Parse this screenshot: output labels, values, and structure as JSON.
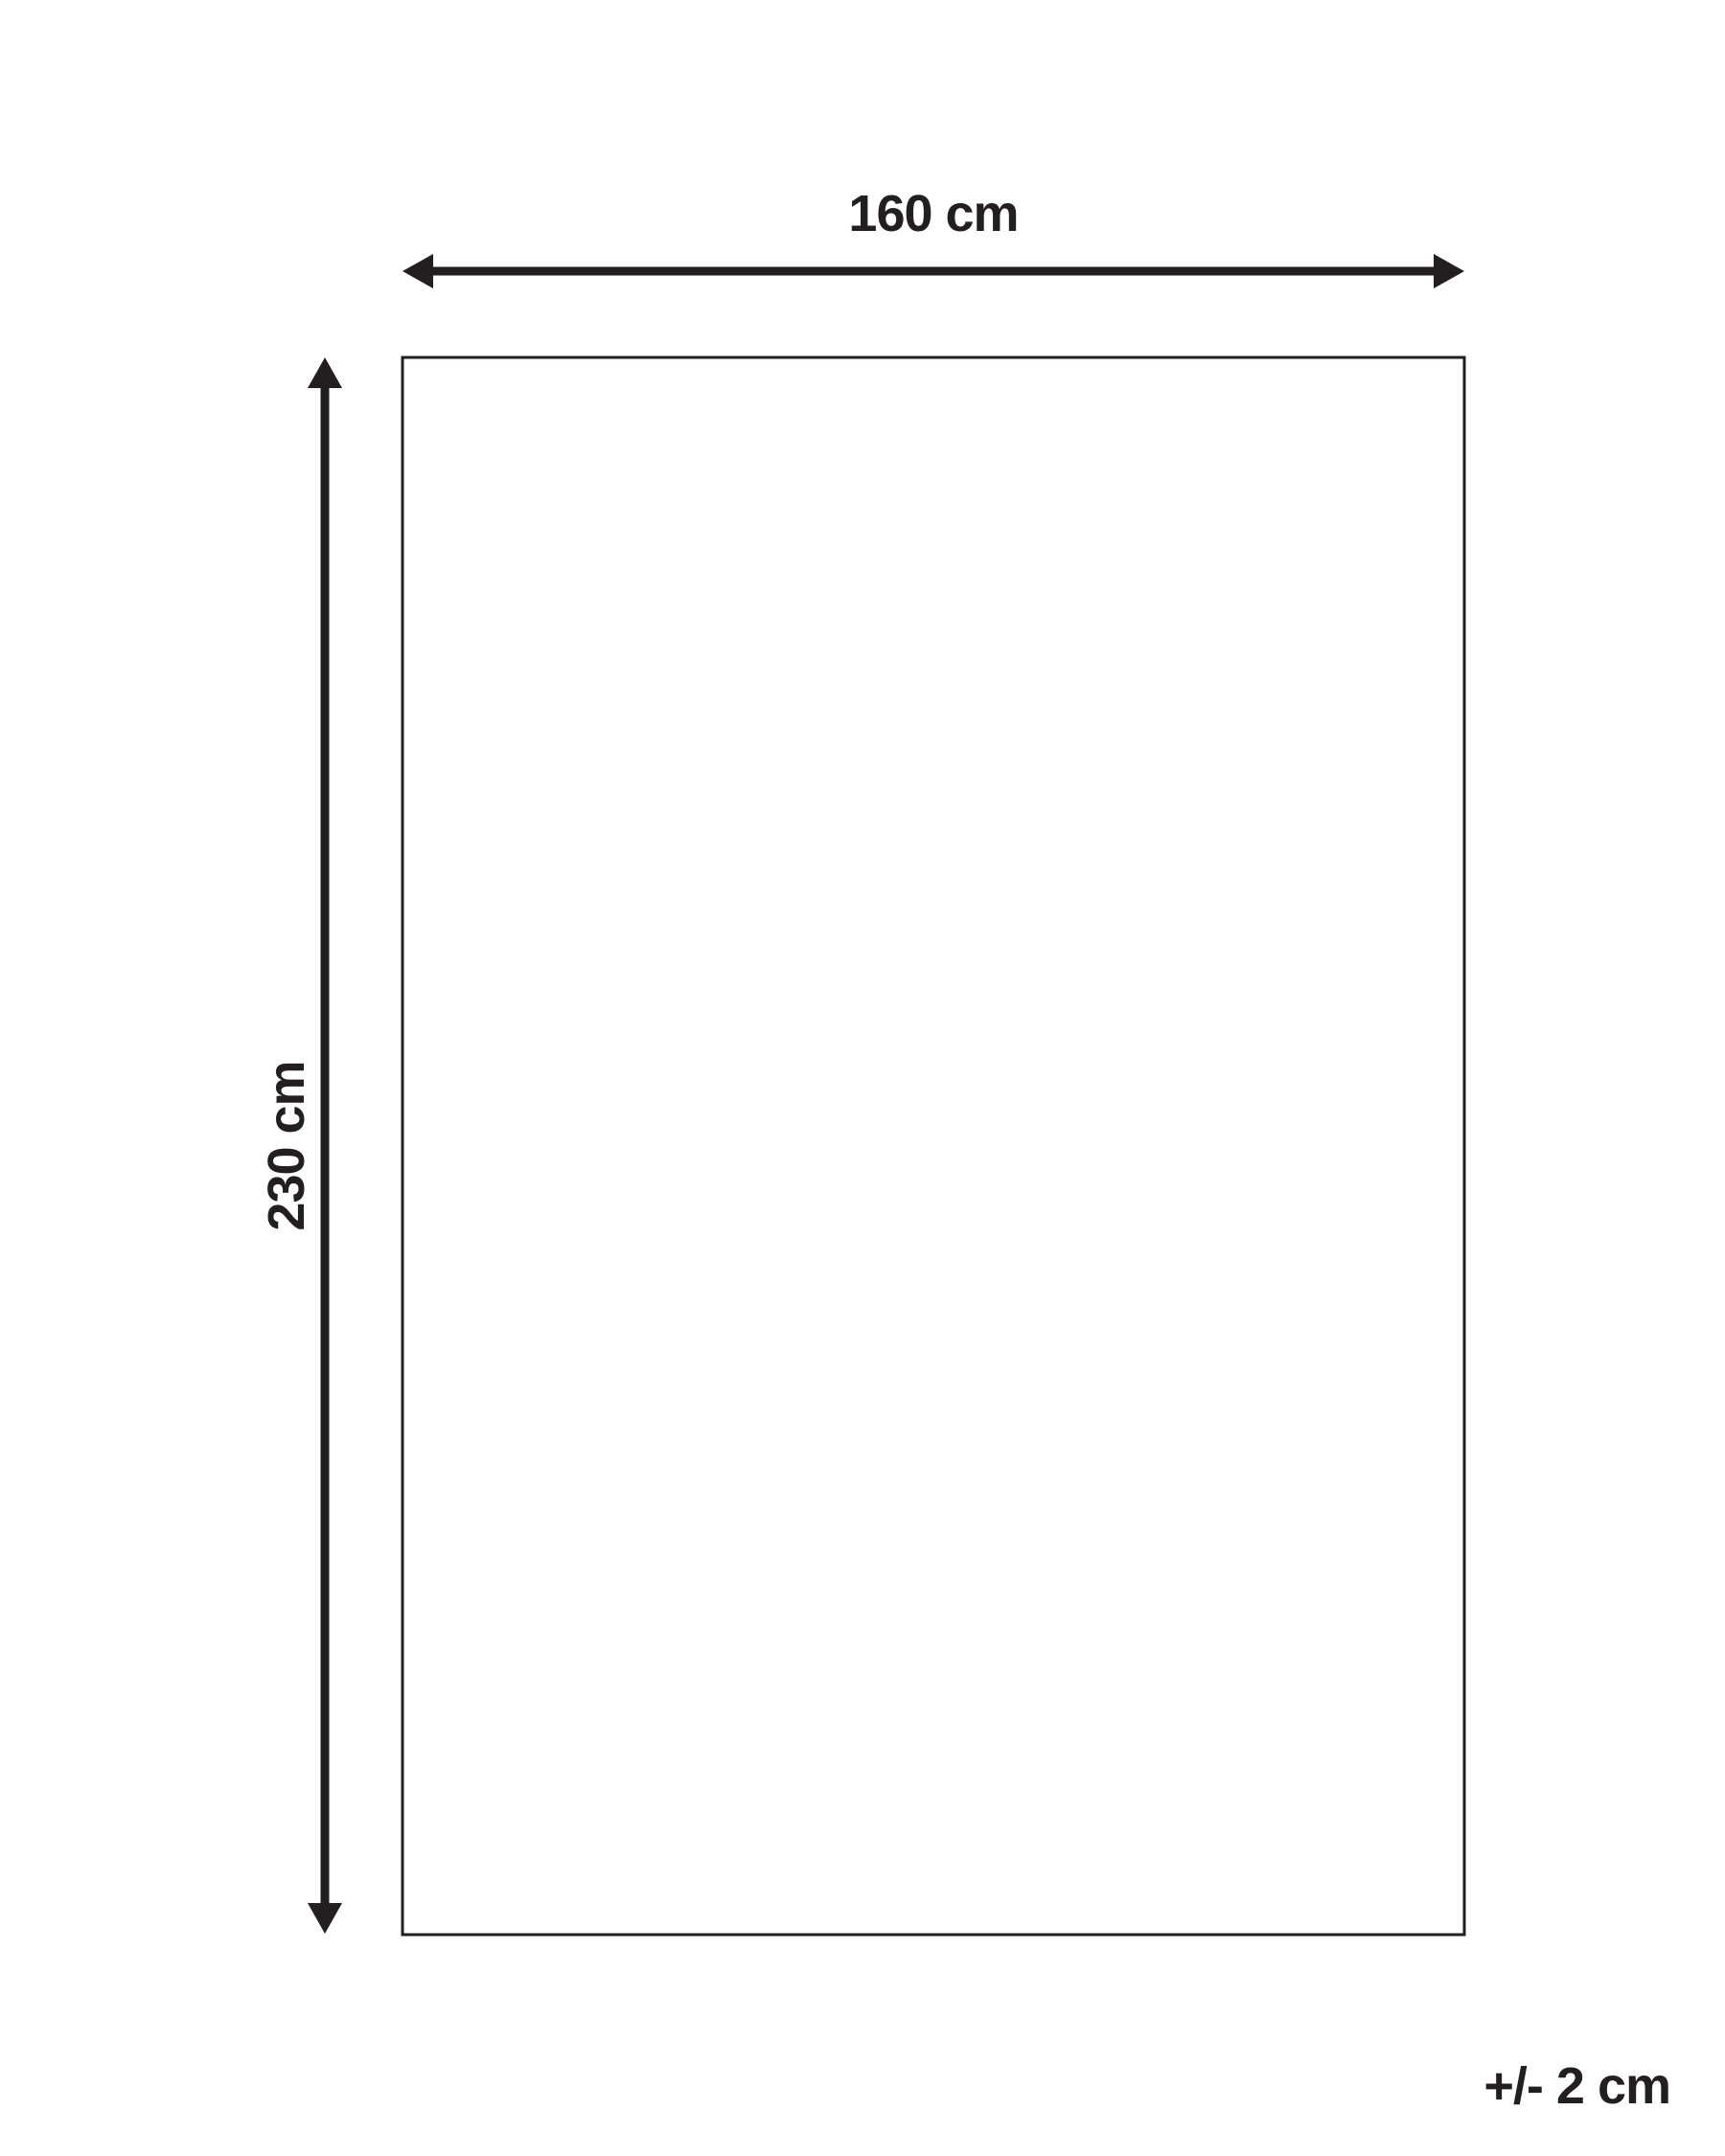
{
  "diagram": {
    "width_label": "160 cm",
    "height_label": "230 cm",
    "tolerance_label": "+/- 2 cm"
  },
  "colors": {
    "ink": "#231f20",
    "background": "#ffffff"
  }
}
